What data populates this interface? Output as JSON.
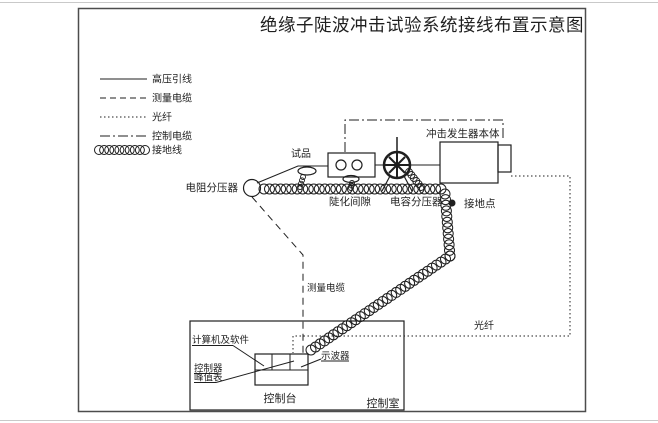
{
  "title": "绝缘子陡波冲击试验系统接线布置示意图",
  "legend": {
    "items": [
      {
        "label": "高压引线",
        "style": "solid"
      },
      {
        "label": "测量电缆",
        "style": "dashed"
      },
      {
        "label": "光纤",
        "style": "dotted"
      },
      {
        "label": "控制电缆",
        "style": "dash-dot"
      },
      {
        "label": "接地线",
        "style": "coil"
      }
    ]
  },
  "labels": {
    "test_object": "试品",
    "resistive_divider": "电阻分压器",
    "steepening_gap": "陡化间隙",
    "capacitive_divider": "电容分压器",
    "impulse_generator": "冲击发生器本体",
    "ground_point": "接地点",
    "measuring_cable": "测量电缆",
    "optical_fiber": "光纤",
    "computer_software": "计算机及软件",
    "controller": "控制器",
    "peak_meter": "峰值表",
    "oscilloscope": "示波器",
    "control_console": "控制台",
    "control_room": "控制室"
  },
  "colors": {
    "ink": "#1f1f1f",
    "border": "#4d4d4d",
    "background": "#ffffff"
  }
}
